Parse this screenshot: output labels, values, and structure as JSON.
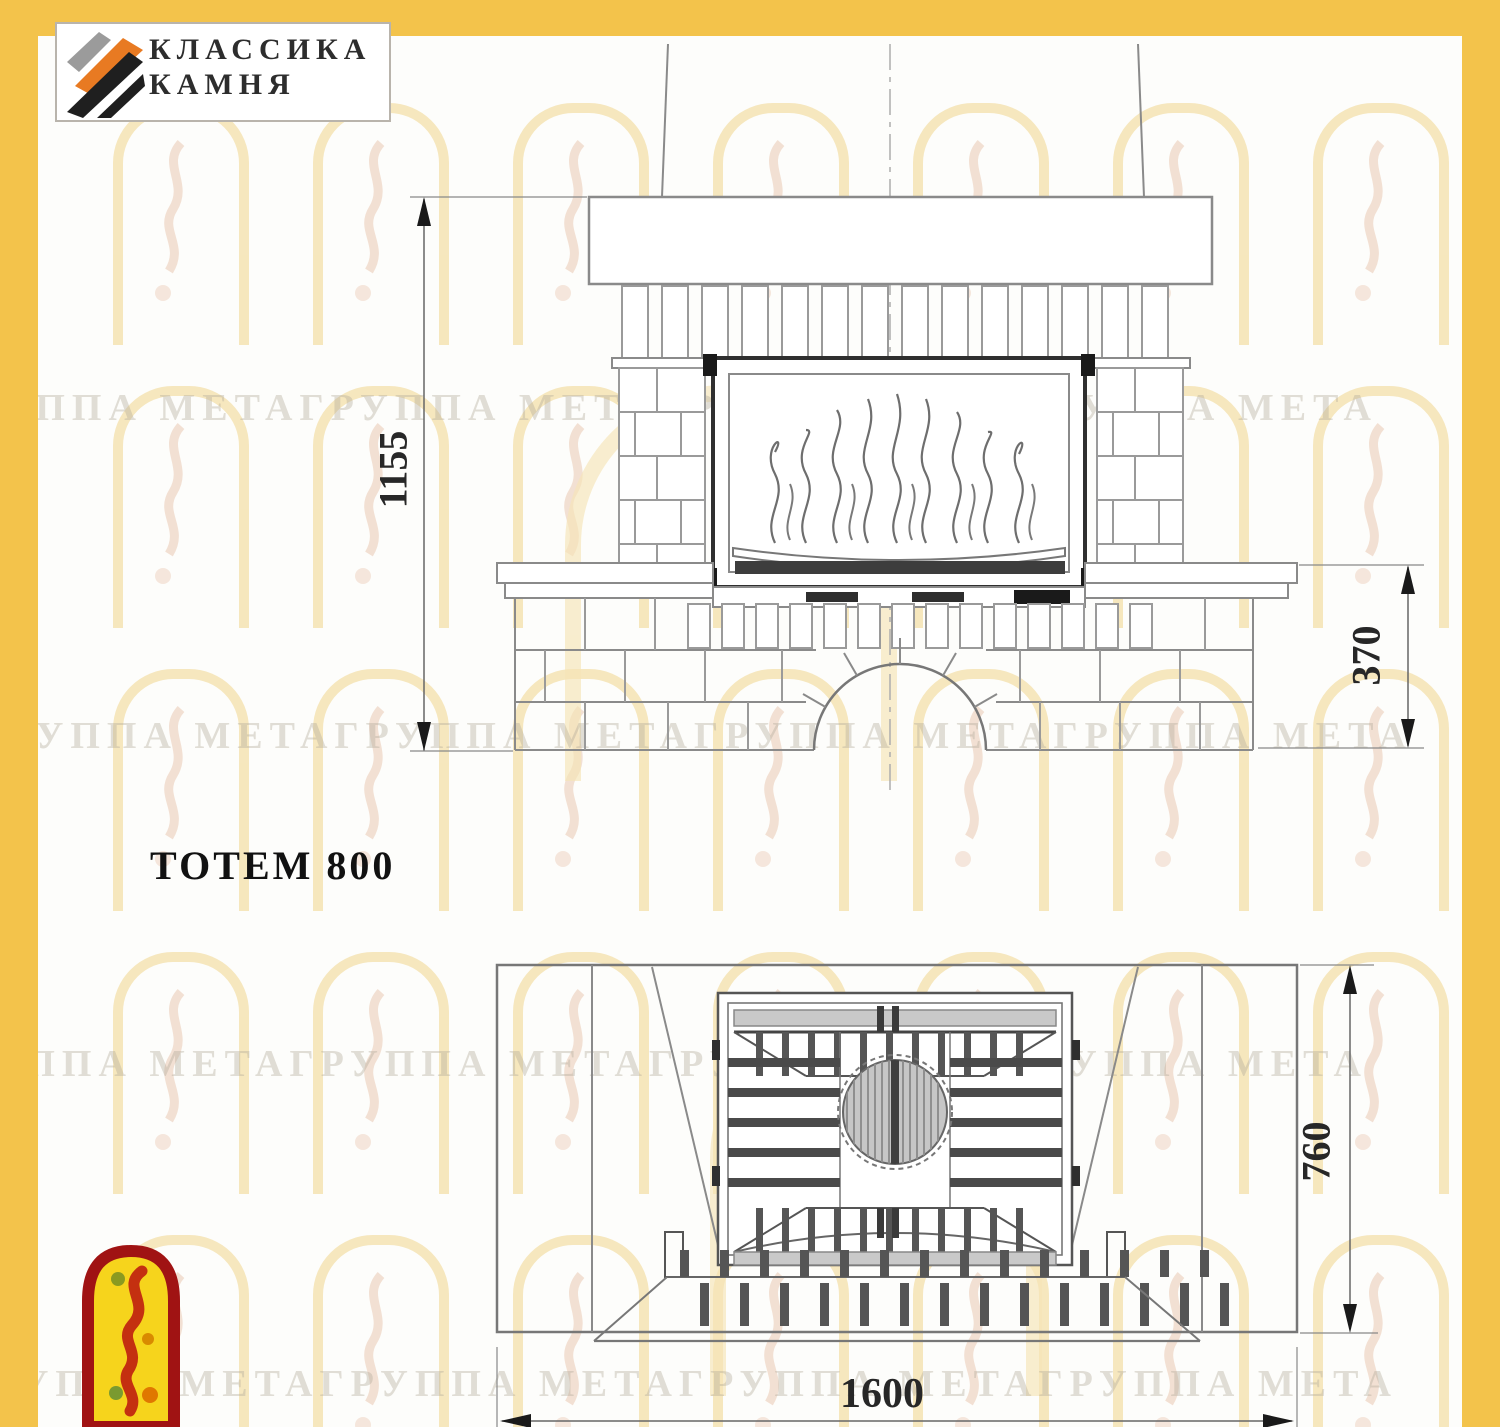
{
  "brand": {
    "name_line1": "КЛАССИКА",
    "name_line2": "КАМНЯ"
  },
  "model": {
    "label": "ТОТЕМ 800"
  },
  "dimensions": {
    "front_height_mm": "1155",
    "bench_height_mm": "370",
    "plan_width_mm": "1600",
    "plan_depth_mm": "760"
  },
  "watermark": {
    "row_text": "ГРУППА МЕТАГРУППА МЕТАГРУППА МЕТАГРУППА МЕТА"
  },
  "colors": {
    "frame_yellow": "#F3C34B",
    "logo_orange": "#E87A22",
    "logo_gray": "#9B9B9B",
    "logo_black": "#1F1F1F",
    "drawing_line_gray": "#8A8A8A",
    "mini_logo_red": "#A01313",
    "mini_logo_yellow": "#F6D41C"
  }
}
